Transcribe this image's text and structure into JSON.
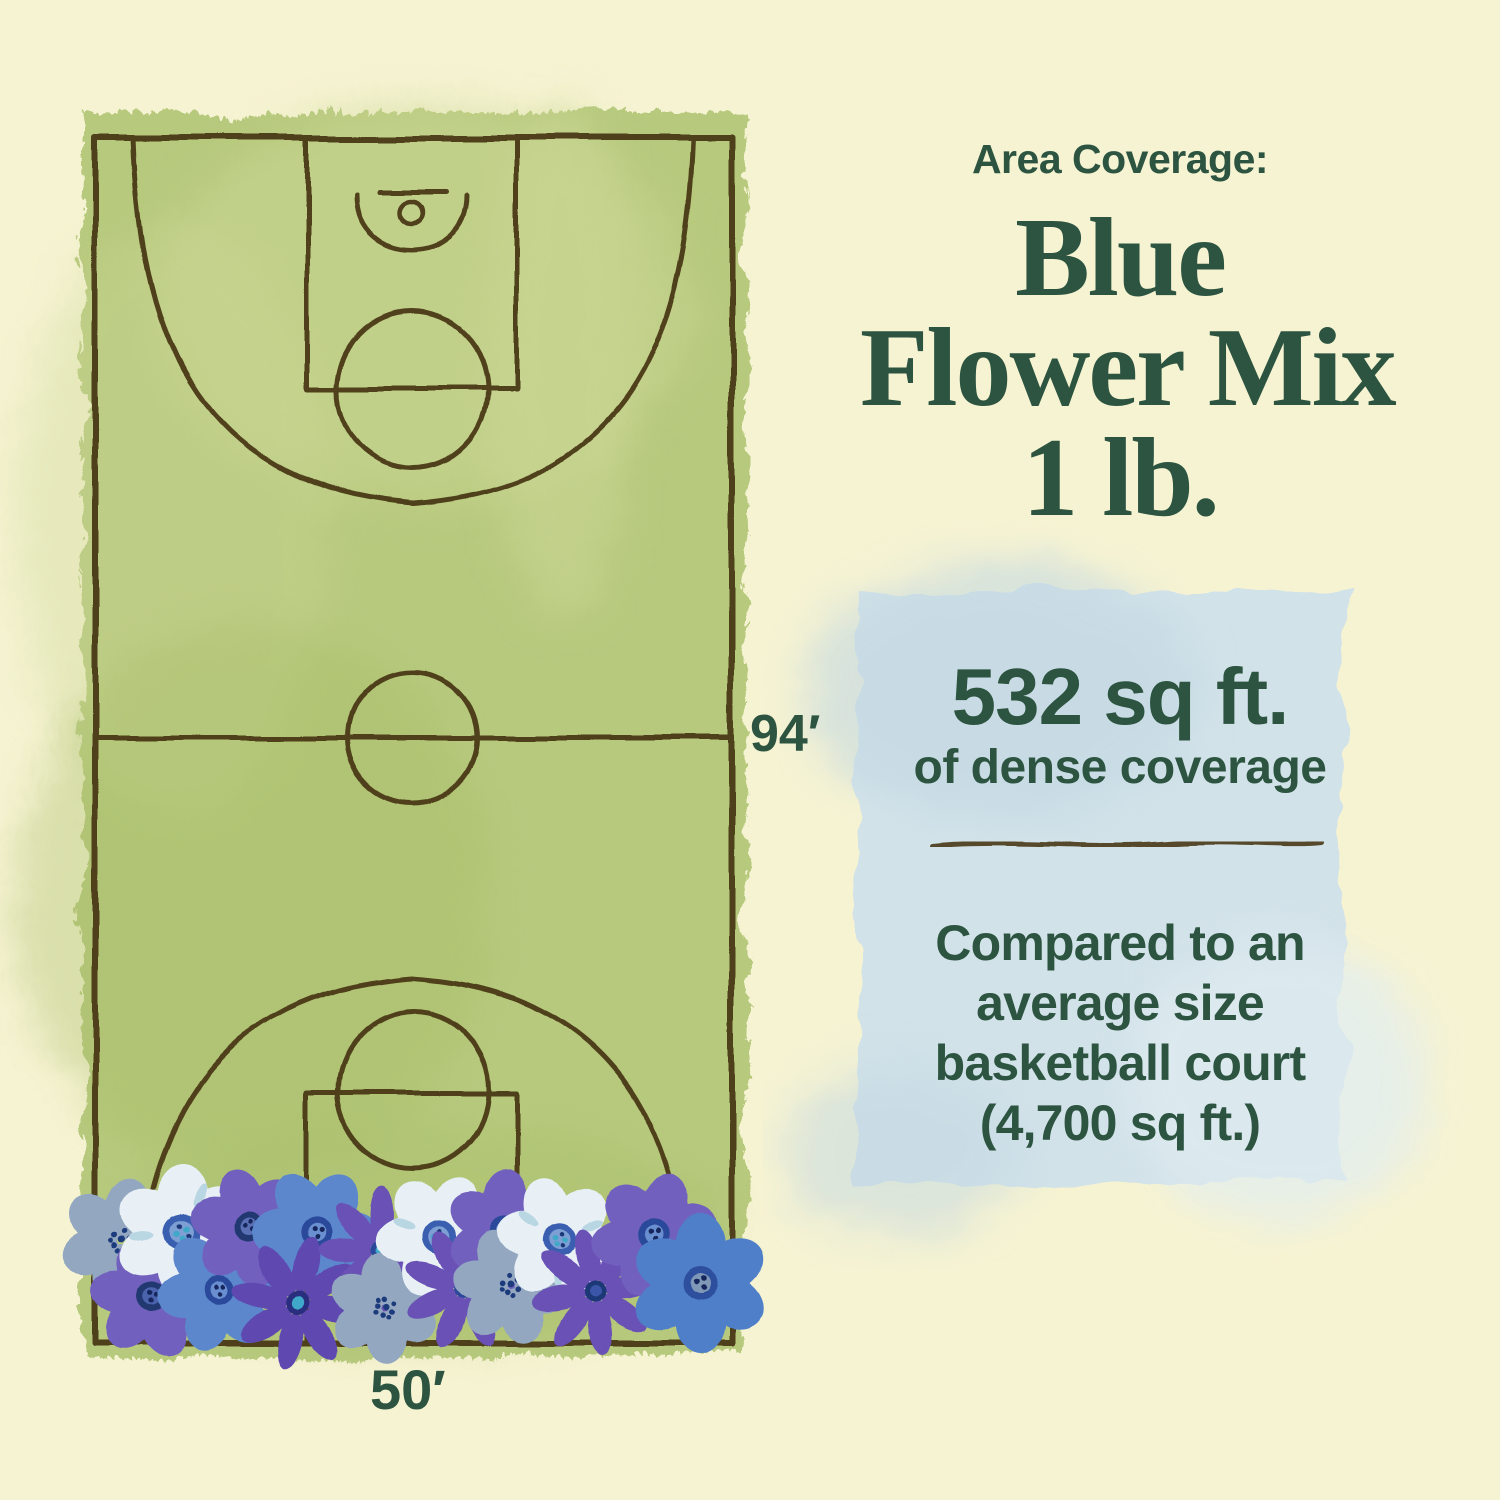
{
  "header": {
    "eyebrow": "Area Coverage:",
    "title_lines": [
      "Blue",
      "Flower Mix",
      "1 lb."
    ]
  },
  "court_diagram": {
    "length_label": "94′",
    "width_label": "50′"
  },
  "coverage_panel": {
    "headline": "532 sq ft.",
    "subheadline": "of dense coverage",
    "comparison_lines": [
      "Compared to an",
      "average size",
      "basketball court",
      "(4,700 sq ft.)"
    ]
  },
  "colors": {
    "background": "#f6f3d2",
    "accent": "#2c5440",
    "court-green": "#b7c97d",
    "court-green-light": "#cbd795",
    "court-green-dark": "#a6bc66",
    "court-line": "#4a3918",
    "panel-blue": "#d2e2e9",
    "panel-blue-dark": "#c2d8e2",
    "panel-blue-light": "#e0edf2",
    "flower-violet": "#7160bd",
    "flower-deep-violet": "#5f48b0",
    "flower-purple": "#6a51b5",
    "flower-blue": "#5b87cd",
    "flower-deep-blue": "#4f7fc9",
    "flower-pale": "#e8f0f5",
    "flower-slate": "#93a7c0",
    "flower-center-navy": "#2b4a9a",
    "flower-center-teal": "#3fa8c9"
  }
}
